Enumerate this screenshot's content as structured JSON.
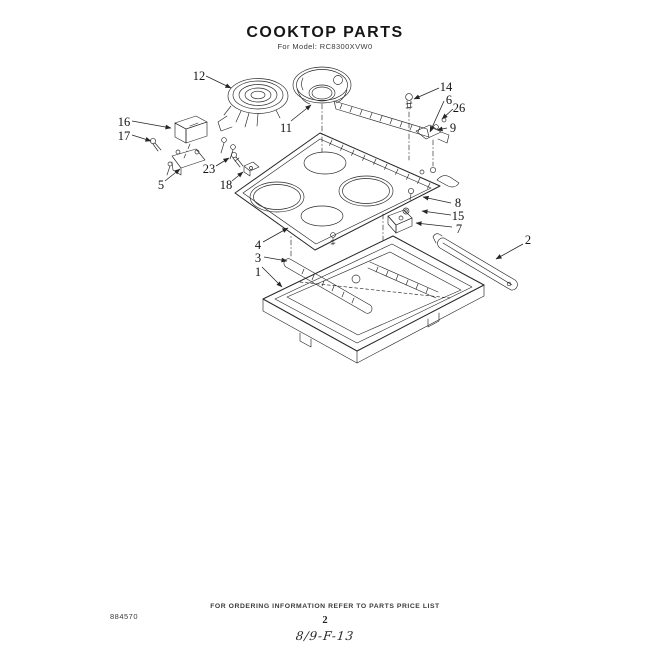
{
  "header": {
    "title": "COOKTOP PARTS",
    "subtitle": "For Model: RC8300XVW0"
  },
  "footer": {
    "ordering_note": "FOR ORDERING INFORMATION REFER TO PARTS PRICE LIST",
    "page_number": "2",
    "handwritten_ref": "8/9-F-13",
    "doc_number": "884570"
  },
  "diagram": {
    "callouts": [
      {
        "label": "12"
      },
      {
        "label": "11"
      },
      {
        "label": "14"
      },
      {
        "label": "6"
      },
      {
        "label": "26"
      },
      {
        "label": "9"
      },
      {
        "label": "16"
      },
      {
        "label": "17"
      },
      {
        "label": "5"
      },
      {
        "label": "23"
      },
      {
        "label": "18"
      },
      {
        "label": "8"
      },
      {
        "label": "15"
      },
      {
        "label": "7"
      },
      {
        "label": "2"
      },
      {
        "label": "4"
      },
      {
        "label": "3"
      },
      {
        "label": "1"
      }
    ]
  },
  "colors": {
    "ink": "#262626",
    "paper": "#ffffff"
  }
}
